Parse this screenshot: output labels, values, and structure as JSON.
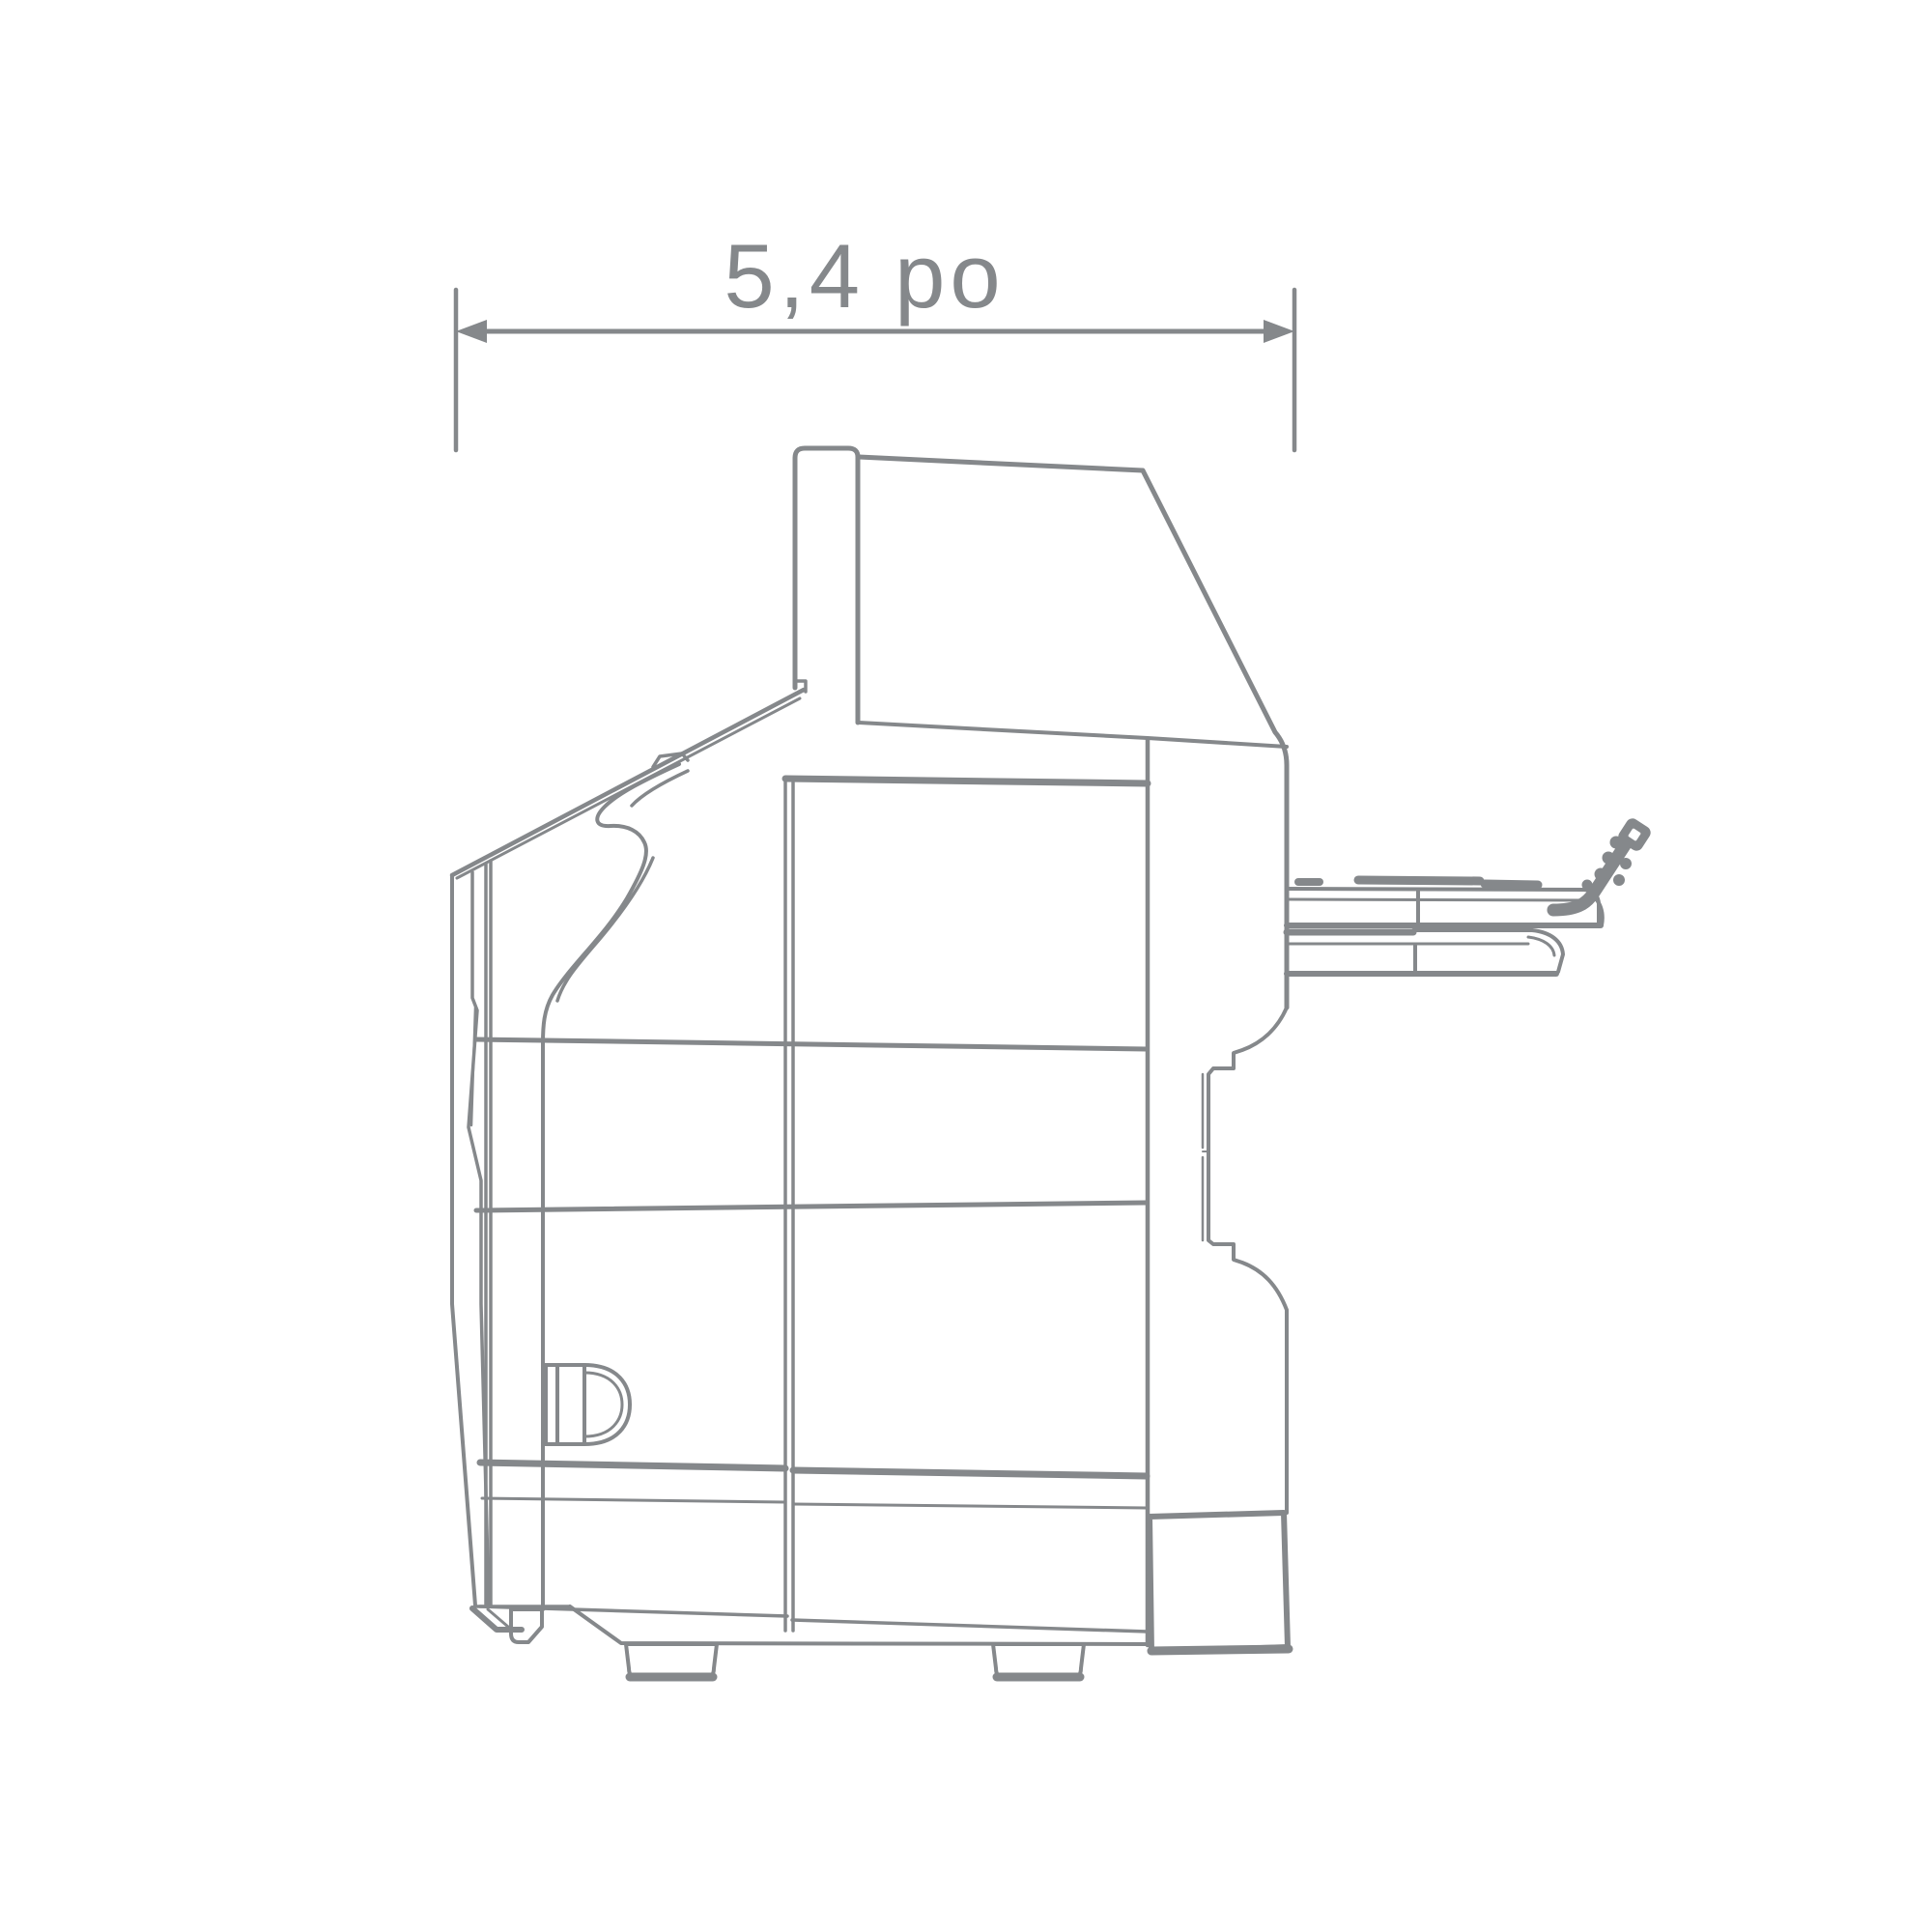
{
  "diagram": {
    "type": "technical-dimension-drawing",
    "subject": "appliance-side-view",
    "dimension": {
      "label": "5,4 po",
      "value": "5,4",
      "unit": "po"
    },
    "colors": {
      "line": "#85888b",
      "background": "#ffffff"
    }
  }
}
